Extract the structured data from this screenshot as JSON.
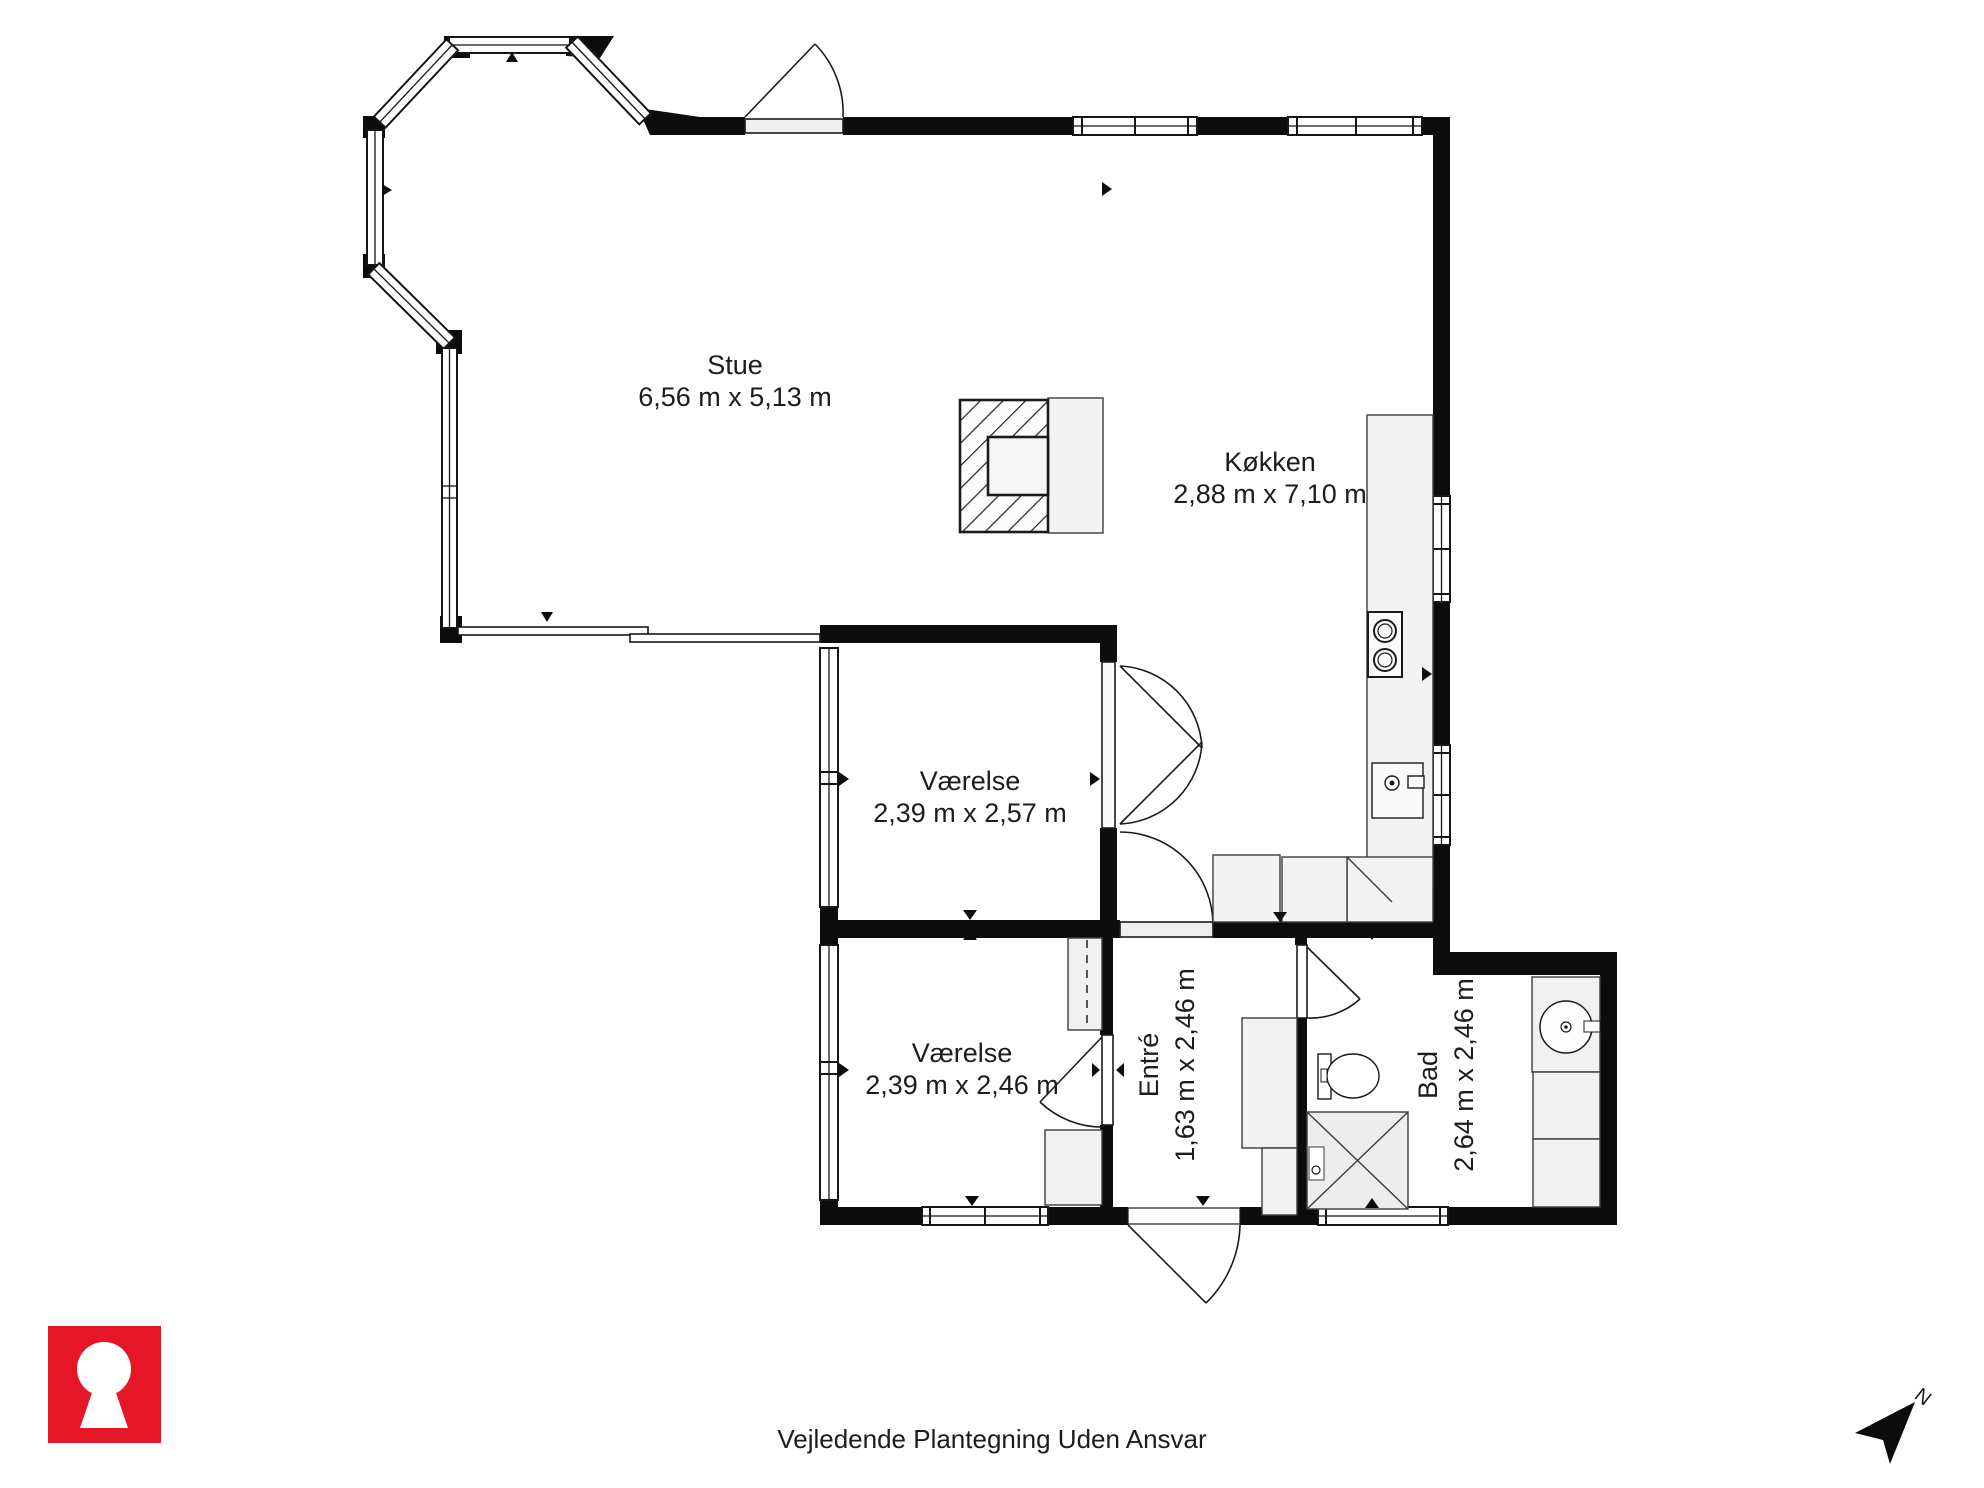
{
  "rooms": {
    "stue": {
      "name": "Stue",
      "dimensions": "6,56 m x 5,13 m"
    },
    "kokken": {
      "name": "Køkken",
      "dimensions": "2,88 m x 7,10 m"
    },
    "vaerelse1": {
      "name": "Værelse",
      "dimensions": "2,39 m x 2,57 m"
    },
    "vaerelse2": {
      "name": "Værelse",
      "dimensions": "2,39 m x 2,46 m"
    },
    "entre": {
      "name": "Entré",
      "dimensions": "1,63 m x 2,46 m"
    },
    "bad": {
      "name": "Bad",
      "dimensions": "2,64 m x 2,46 m"
    }
  },
  "footer": {
    "disclaimer": "Vejledende Plantegning Uden Ansvar"
  },
  "compass": {
    "north_label": "N"
  },
  "colors": {
    "wall": "#0c0c0c",
    "accent_red": "#e51626",
    "counter_fill": "#f2f2f2",
    "text": "#1c1c1e"
  }
}
